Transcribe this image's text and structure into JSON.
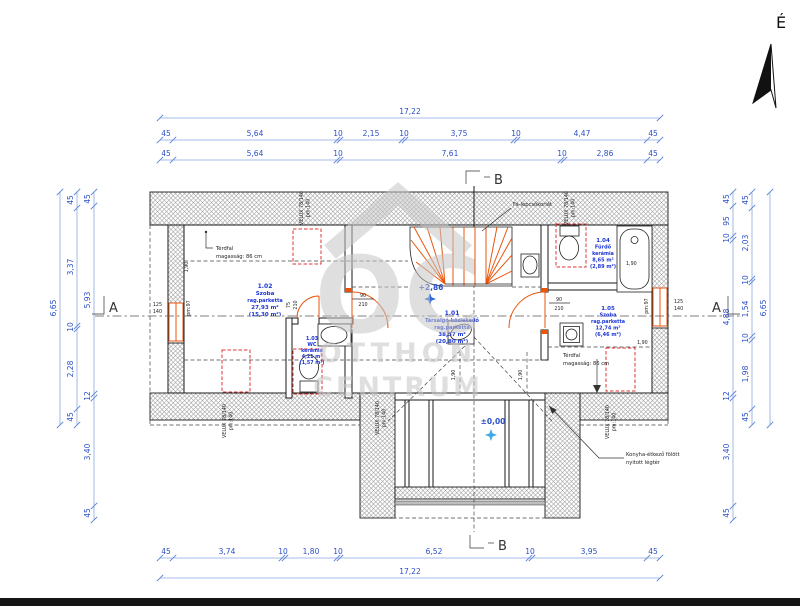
{
  "page": {
    "north": "É"
  },
  "watermark": {
    "monogram": "OC",
    "line1": "OTTHON",
    "line2": "CENTRUM"
  },
  "dimensions": {
    "top_overall": "17,22",
    "top_row1": [
      "45",
      "5,64",
      "10",
      "2,15",
      "10",
      "3,75",
      "10",
      "4,47",
      "45"
    ],
    "top_row2": [
      "45",
      "5,64",
      "10",
      "7,61",
      "10",
      "2,86",
      "45"
    ],
    "bottom_row": [
      "45",
      "3,74",
      "10",
      "1,80",
      "10",
      "6,52",
      "10",
      "3,95",
      "45"
    ],
    "bottom_overall": "17,22",
    "left_outer": "6,65",
    "left_mid": [
      "45",
      "3,37",
      "10",
      "2,28",
      "45"
    ],
    "left_inner": [
      "45",
      "5,93",
      "12",
      "3,40",
      "45"
    ],
    "right_inner": [
      "45",
      "95",
      "10",
      "4,88",
      "12",
      "3,40",
      "45"
    ],
    "right_mid": [
      "45",
      "2,03",
      "10",
      "1,54",
      "10",
      "1,98",
      "45"
    ],
    "right_outer": "6,65"
  },
  "section_markers": {
    "a": "A",
    "b": "B"
  },
  "levels": {
    "upper": "+2,86",
    "ground": "±0,00"
  },
  "rooms": [
    {
      "number": "1.01",
      "name": "Társalgó-közlekedő",
      "finish": "rag.parketta",
      "area": "38,57 m²",
      "reduced_area": "(20,80 m²)"
    },
    {
      "number": "1.02",
      "name": "Szoba",
      "finish": "rag.parketta",
      "area": "27,93 m²",
      "reduced_area": "(15,30 m²)"
    },
    {
      "number": "1.03",
      "name": "WC",
      "finish": "kerámia",
      "area": "4,21 m²",
      "reduced_area": "(1,57 m²)"
    },
    {
      "number": "1.04",
      "name": "Fürdő",
      "finish": "kerámia",
      "area": "8,65 m²",
      "reduced_area": "(2,89 m²)"
    },
    {
      "number": "1.05",
      "name": "Szoba",
      "finish": "rag.parketta",
      "area": "12,74 m²",
      "reduced_area": "(6,46 m²)"
    }
  ],
  "annotations": {
    "knee_wall_line1": "Térdfal",
    "knee_wall_line2": "magasság: 86 cm",
    "stair_rail": "Fa-lépcsőkorlát",
    "kitchen_void_line1": "Konyha-étkező fölött",
    "kitchen_void_line2": "nyitott légtér",
    "headroom": "1,90"
  },
  "openings": {
    "velux_type": "VELUX 78/140",
    "velux_pm": "pm:140",
    "window_width": "125",
    "window_height": "140",
    "window_pm": "pm:97",
    "door_width": "90",
    "door_height": "210",
    "wc_door_width": "75"
  },
  "colors": {
    "dimension": "#2a4fc8",
    "room_label": "#1b35d6",
    "accent_orange": "#e8560e",
    "velux_red": "#e03333",
    "level_star": "#3fa9e8"
  }
}
